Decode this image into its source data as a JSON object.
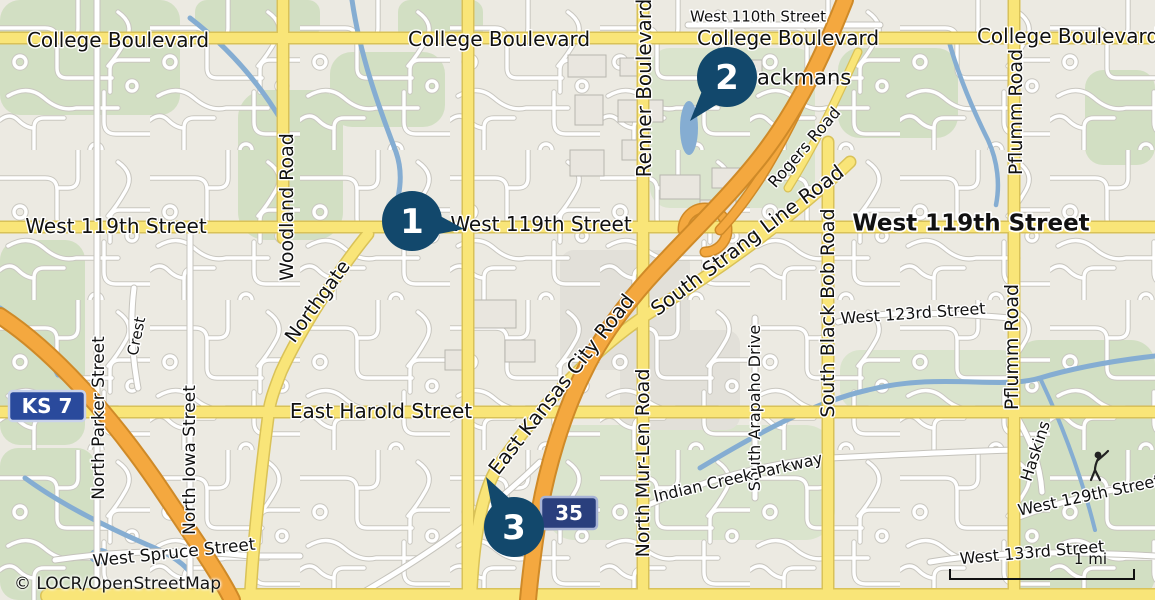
{
  "map": {
    "attribution": "© LOCR/OpenStreetMap",
    "scale": {
      "label": "1 mi"
    },
    "colors": {
      "marker": "#12486c",
      "major_road": "#f9e578",
      "highway": "#f4a83f",
      "water": "#85add2",
      "land": "#eceae2",
      "park": "#d2dfc3"
    },
    "markers": [
      {
        "name": "map-marker-1",
        "label": "1",
        "cx": 412,
        "cy": 221,
        "tipx": 464,
        "tipy": 229
      },
      {
        "name": "map-marker-2",
        "label": "2",
        "cx": 727,
        "cy": 77,
        "tipx": 690,
        "tipy": 121
      },
      {
        "name": "map-marker-3",
        "label": "3",
        "cx": 514,
        "cy": 527,
        "tipx": 486,
        "tipy": 477
      }
    ],
    "shields": [
      {
        "name": "ks7-shield",
        "label": "KS 7",
        "x": 9,
        "y": 391,
        "w": 76,
        "h": 30,
        "rx": 4,
        "fill": "#2a4a9c",
        "border": "#c9d2ea",
        "size": 20
      },
      {
        "name": "i35-shield",
        "label": "35",
        "x": 541,
        "y": 497,
        "w": 56,
        "h": 32,
        "rx": 4,
        "fill": "#2a3f7d",
        "border": "#a7b3d6",
        "size": 20
      }
    ],
    "street_labels": [
      {
        "name": "label-college-blvd-1",
        "text": "College Boulevard",
        "x": 118,
        "y": 40,
        "rot": 0,
        "size": 20
      },
      {
        "name": "label-college-blvd-2",
        "text": "College Boulevard",
        "x": 499,
        "y": 39,
        "rot": 0,
        "size": 20
      },
      {
        "name": "label-college-blvd-3",
        "text": "College Boulevard",
        "x": 788,
        "y": 38,
        "rot": 0,
        "size": 20
      },
      {
        "name": "label-college-blvd-4",
        "text": "College Boulevard",
        "x": 1068,
        "y": 36,
        "rot": 0,
        "size": 20
      },
      {
        "name": "label-west-110th-street",
        "text": "West 110th Street",
        "x": 758,
        "y": 16,
        "rot": 0,
        "size": 15
      },
      {
        "name": "label-blackmans",
        "text": "Blackmans",
        "x": 794,
        "y": 77,
        "rot": 0,
        "size": 21
      },
      {
        "name": "label-west-119th-street-1",
        "text": "West 119th Street",
        "x": 116,
        "y": 226,
        "rot": 0,
        "size": 20
      },
      {
        "name": "label-west-119th-street-2",
        "text": "West 119th Street",
        "x": 541,
        "y": 224,
        "rot": 0,
        "size": 20
      },
      {
        "name": "label-west-119th-street-3",
        "text": "West 119th Street",
        "x": 971,
        "y": 222,
        "rot": 0,
        "size": 23,
        "bold": true
      },
      {
        "name": "label-woodland-road",
        "text": "Woodland Road",
        "x": 286,
        "y": 207,
        "rot": -90,
        "size": 19
      },
      {
        "name": "label-renner-boulevard",
        "text": "Renner Boulevard",
        "x": 644,
        "y": 88,
        "rot": -90,
        "size": 20
      },
      {
        "name": "label-northgate",
        "text": "Northgate",
        "x": 317,
        "y": 301,
        "rot": -54,
        "size": 19
      },
      {
        "name": "label-rogers-road",
        "text": "Rogers Road",
        "x": 804,
        "y": 147,
        "rot": -49,
        "size": 16
      },
      {
        "name": "label-south-strang-line-road",
        "text": "South Strang Line Road",
        "x": 747,
        "y": 240,
        "rot": -37,
        "size": 20
      },
      {
        "name": "label-east-kansas-city-road",
        "text": "East Kansas City Road",
        "x": 561,
        "y": 384,
        "rot": -52,
        "size": 20
      },
      {
        "name": "label-north-mur-len-road",
        "text": "North Mur-Len Road",
        "x": 642,
        "y": 463,
        "rot": -90,
        "size": 19
      },
      {
        "name": "label-south-arapaho-drive",
        "text": "South Arapaho Drive",
        "x": 754,
        "y": 408,
        "rot": -90,
        "size": 16
      },
      {
        "name": "label-indian-creek-parkway",
        "text": "Indian Creek Parkway",
        "x": 738,
        "y": 477,
        "rot": -13,
        "size": 16
      },
      {
        "name": "label-east-harold-street",
        "text": "East Harold Street",
        "x": 381,
        "y": 411,
        "rot": 0,
        "size": 20
      },
      {
        "name": "label-west-123rd-street",
        "text": "West 123rd Street",
        "x": 913,
        "y": 313,
        "rot": -4,
        "size": 16
      },
      {
        "name": "label-south-black-bob-road",
        "text": "South Black Bob Road",
        "x": 827,
        "y": 313,
        "rot": -90,
        "size": 19
      },
      {
        "name": "label-pflumm-road-1",
        "text": "Pflumm Road",
        "x": 1015,
        "y": 112,
        "rot": -90,
        "size": 19
      },
      {
        "name": "label-pflumm-road-2",
        "text": "Pflumm Road",
        "x": 1011,
        "y": 347,
        "rot": -90,
        "size": 19
      },
      {
        "name": "label-crest",
        "text": "Crest",
        "x": 136,
        "y": 336,
        "rot": -78,
        "size": 15
      },
      {
        "name": "label-north-parker-street",
        "text": "North Parker Street",
        "x": 98,
        "y": 418,
        "rot": -90,
        "size": 17
      },
      {
        "name": "label-north-iowa-street",
        "text": "North Iowa Street",
        "x": 189,
        "y": 460,
        "rot": -90,
        "size": 17
      },
      {
        "name": "label-west-spruce-street",
        "text": "West Spruce Street",
        "x": 174,
        "y": 552,
        "rot": -6,
        "size": 17
      },
      {
        "name": "label-haskins",
        "text": "Haskins",
        "x": 1035,
        "y": 451,
        "rot": -72,
        "size": 16
      },
      {
        "name": "label-west-129th-street",
        "text": "West 129th Street",
        "x": 1089,
        "y": 495,
        "rot": -12,
        "size": 16
      },
      {
        "name": "label-west-133rd-street",
        "text": "West 133rd Street",
        "x": 1032,
        "y": 552,
        "rot": -5,
        "size": 16
      }
    ]
  }
}
